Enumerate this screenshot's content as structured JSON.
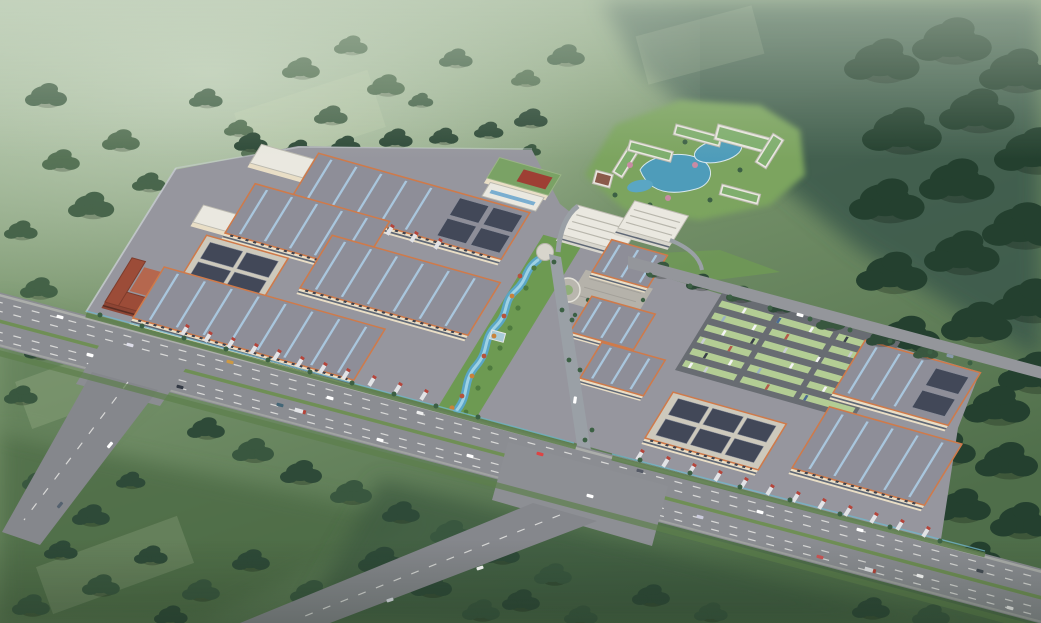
{
  "scene": {
    "title": "Aerial bird's-eye architectural rendering of a logistics industrial park campus among hazy green hills",
    "setting": "3D masterplan visualization: misty farmland to the northwest, dense forested hills to the east, a six-lane highway with interchange along the campus front, fields and tree clusters to the south",
    "regions": {
      "northwest": "hazy farmland with scattered tree clusters",
      "east": "dark forested hillside",
      "south": "green fields with tree groves and branch roads",
      "campus": "warehouse park with loading docks and truck courts",
      "north_resort": "white resort buildings with green roofs around blue lagoons",
      "headquarters": "white stepped office complex with plaza and circular garden",
      "center": "landscaped linear park with winding blue stream and fountain",
      "west": "red-brick dormitory block with courtyard",
      "east_lot": "visitor parking lot with green stalls and cars"
    },
    "features": {
      "warehouse_roofs": "gray with pale-blue skylight stripes and orange trim",
      "solar_roofs": "beige roofs with dark photovoltaic panel grids",
      "highway": "dual carriageway, green median, dashed lanes, cars and trucks",
      "docks": "rows of trucks parked diagonally along warehouse fronts"
    },
    "counts": {
      "large_warehouses": 12,
      "ponds": 4,
      "parking_rows": 6,
      "highway_lane_lines": 4,
      "intersections": 2
    },
    "palette": {
      "warehouse_roof": "#8e8e98",
      "roof_trim": "#cf7a4a",
      "skylight_stripe": "#a9c6dd",
      "solar_panel": "#424858",
      "facade_cream": "#e9dec6",
      "asphalt": "#8b8d92",
      "campus_pad": "#96969e",
      "lawn": "#6f9a55",
      "pond_blue": "#4e9cba",
      "forest_green": "#2e4a38",
      "haze": "#cdd9c8",
      "parking_stall": "#bcd49c",
      "dorm_brick": "#9c4c38",
      "resort_roof": "#7fae6d",
      "office_white": "#eae8e0"
    }
  }
}
